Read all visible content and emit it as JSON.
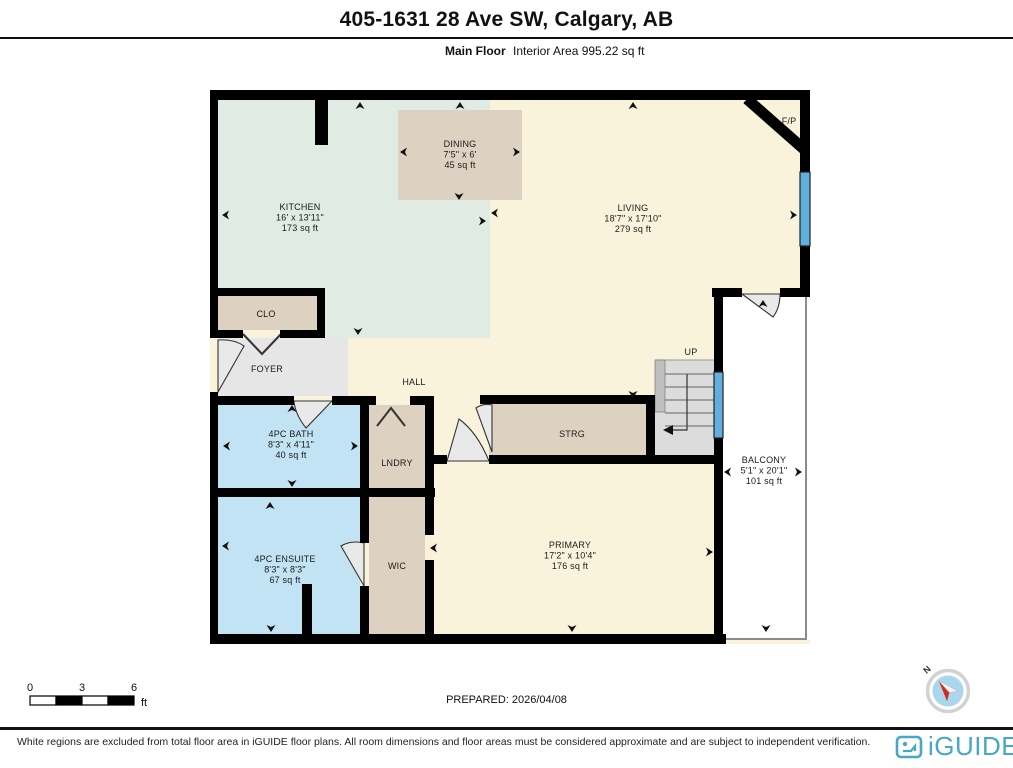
{
  "header": {
    "title": "405-1631 28 Ave SW, Calgary, AB",
    "floor_label": "Main Floor",
    "area_label": "Interior Area 995.22 sq ft"
  },
  "plan": {
    "rooms": [
      {
        "name": "KITCHEN",
        "dim": "16' x 13'11\"",
        "area": "173 sq ft",
        "x": 300,
        "y": 210
      },
      {
        "name": "DINING",
        "dim": "7'5\" x 6'",
        "area": "45 sq ft",
        "x": 460,
        "y": 147
      },
      {
        "name": "LIVING",
        "dim": "18'7\" x 17'10\"",
        "area": "279 sq ft",
        "x": 633,
        "y": 211
      },
      {
        "name": "F/P",
        "x": 789,
        "y": 124
      },
      {
        "name": "CLO",
        "x": 266,
        "y": 317
      },
      {
        "name": "FOYER",
        "x": 267,
        "y": 372
      },
      {
        "name": "HALL",
        "x": 414,
        "y": 385
      },
      {
        "name": "UP",
        "x": 691,
        "y": 355
      },
      {
        "name": "STRG",
        "x": 572,
        "y": 437
      },
      {
        "name": "4PC BATH",
        "dim": "8'3\" x 4'11\"",
        "area": "40 sq ft",
        "x": 291,
        "y": 437
      },
      {
        "name": "LNDRY",
        "x": 397,
        "y": 466
      },
      {
        "name": "BALCONY",
        "dim": "5'1\" x 20'1\"",
        "area": "101 sq ft",
        "x": 764,
        "y": 463
      },
      {
        "name": "4PC ENSUITE",
        "dim": "8'3\" x 8'3\"",
        "area": "67 sq ft",
        "x": 285,
        "y": 562
      },
      {
        "name": "WIC",
        "x": 397,
        "y": 569
      },
      {
        "name": "PRIMARY",
        "dim": "17'2\" x 10'4\"",
        "area": "176 sq ft",
        "x": 570,
        "y": 548
      }
    ],
    "dim_arrows": [
      {
        "x": 360,
        "y": 106,
        "d": "u"
      },
      {
        "x": 460,
        "y": 106,
        "d": "u"
      },
      {
        "x": 633,
        "y": 106,
        "d": "u"
      },
      {
        "x": 404,
        "y": 152,
        "d": "l"
      },
      {
        "x": 516,
        "y": 152,
        "d": "r"
      },
      {
        "x": 459,
        "y": 196,
        "d": "d"
      },
      {
        "x": 226,
        "y": 215,
        "d": "l"
      },
      {
        "x": 482,
        "y": 221,
        "d": "r"
      },
      {
        "x": 495,
        "y": 213,
        "d": "l"
      },
      {
        "x": 793,
        "y": 215,
        "d": "r"
      },
      {
        "x": 358,
        "y": 331,
        "d": "d"
      },
      {
        "x": 633,
        "y": 394,
        "d": "d"
      },
      {
        "x": 292,
        "y": 409,
        "d": "u"
      },
      {
        "x": 227,
        "y": 446,
        "d": "l"
      },
      {
        "x": 354,
        "y": 446,
        "d": "r"
      },
      {
        "x": 292,
        "y": 483,
        "d": "d"
      },
      {
        "x": 270,
        "y": 506,
        "d": "u"
      },
      {
        "x": 226,
        "y": 546,
        "d": "l"
      },
      {
        "x": 271,
        "y": 628,
        "d": "d"
      },
      {
        "x": 434,
        "y": 548,
        "d": "l"
      },
      {
        "x": 709,
        "y": 552,
        "d": "r"
      },
      {
        "x": 572,
        "y": 628,
        "d": "d"
      },
      {
        "x": 728,
        "y": 472,
        "d": "l"
      },
      {
        "x": 798,
        "y": 472,
        "d": "r"
      },
      {
        "x": 766,
        "y": 628,
        "d": "d"
      },
      {
        "x": 763,
        "y": 304,
        "d": "u"
      }
    ]
  },
  "scale_bar": {
    "ticks": [
      "0",
      "3",
      "6"
    ],
    "unit": "ft"
  },
  "prepared_label": "PREPARED: 2026/04/08",
  "compass": {
    "label": "N"
  },
  "footer": {
    "disclaimer": "White regions are excluded from total floor area in iGUIDE floor plans. All room dimensions and floor areas must be considered approximate and are subject to independent verification.",
    "brand": "iGUIDE"
  },
  "colors": {
    "cream": "#FAF3DC",
    "mint": "#E0EBE4",
    "tan": "#DDD2C1",
    "blue": "#C2E3F3",
    "gray": "#E6E6E6",
    "wall": "#000000",
    "win": "#5FB0DF",
    "brand": "#47A7C8",
    "compass": "#ABD7ED",
    "needle": "#D42B1E"
  }
}
